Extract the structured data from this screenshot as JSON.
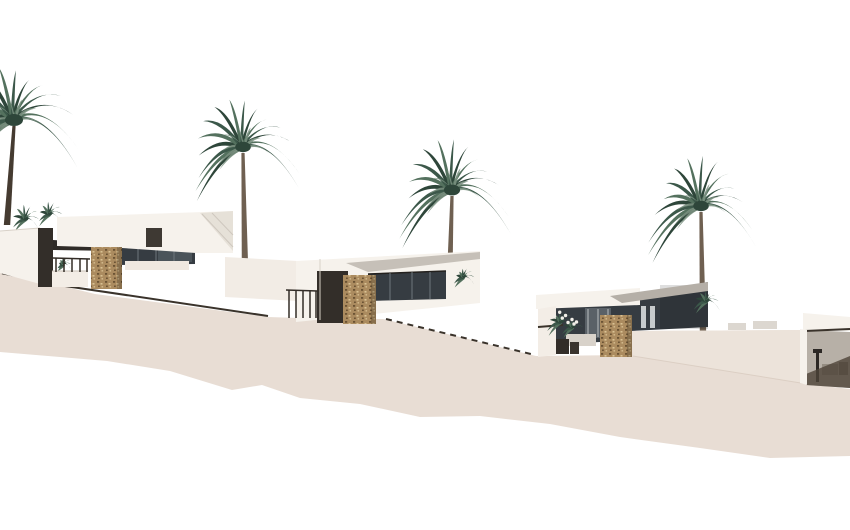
{
  "scene": {
    "type": "architectural-exterior-render",
    "subject": "Row of four modern white flat-roof hillside villas stepping down a beige slope with tall palm trees on a white background",
    "image_width": 850,
    "image_height": 530
  },
  "colors": {
    "background": "#ffffff",
    "terrain": "#e8ddd4",
    "terrain_light": "#ece3da",
    "wall_white": "#f6f2ec",
    "back_wall": "#f2ece5",
    "roof_gray": "#c6c0b8",
    "roof_gray_dark": "#b5afa7",
    "interior_gray": "#b7b0a7",
    "glass": "#363c42",
    "glass_light": "#6d767c",
    "pane_light": "#4b545a",
    "panel_dark": "#332e29",
    "soffit": "#2f2b27",
    "chimney": "#3e3933",
    "line_dark": "#3a332b",
    "stone": "#ab8b5f",
    "stone_dark": "#6b5334",
    "stone_light": "#d9c193",
    "palm_deep": "#2e463a",
    "palm_dark": "#3c584a",
    "palm_mid": "#54715e",
    "palm_light": "#7d9383",
    "trunk": "#6f6051",
    "trunk_dark": "#453b31",
    "shadow_brown": "#4e4338",
    "ledge": "#efe8e0",
    "side_wall": "#f3ede6",
    "sofa": "#d8d2ca",
    "furniture_light": "#948c81",
    "furniture_dark": "#2c2825",
    "distant_roof": "#dcd7d0",
    "crease": "#cfc8bf",
    "edge_light": "#d8d1c8",
    "white_accent": "#f2efe9"
  },
  "palms": [
    {
      "name": "palm-tree-1",
      "crown_x": 14,
      "crown_y": 120,
      "size": 60,
      "base_x": 7,
      "base_y": 225,
      "trunk": "trunk_dark"
    },
    {
      "name": "palm-tree-2",
      "crown_x": 243,
      "crown_y": 147,
      "size": 52,
      "base_x": 245,
      "base_y": 268,
      "trunk": "trunk"
    },
    {
      "name": "palm-tree-3",
      "crown_x": 452,
      "crown_y": 190,
      "size": 54,
      "base_x": 449,
      "base_y": 302,
      "trunk": "trunk"
    },
    {
      "name": "palm-tree-4",
      "crown_x": 701,
      "crown_y": 206,
      "size": 52,
      "base_x": 703,
      "base_y": 332,
      "trunk": "trunk"
    }
  ],
  "bushes": [
    {
      "name": "shrub-left-terrace-a",
      "x": 26,
      "y": 219,
      "size": 15,
      "layer": "back",
      "flowers": false
    },
    {
      "name": "shrub-left-terrace-b",
      "x": 50,
      "y": 214,
      "size": 13,
      "layer": "back",
      "flowers": false
    },
    {
      "name": "planter-plant-villa-1",
      "x": 64,
      "y": 264,
      "size": 7,
      "layer": "mid",
      "flowers": false
    },
    {
      "name": "shrub-villa-2-right",
      "x": 464,
      "y": 277,
      "size": 10,
      "layer": "front",
      "flowers": false
    },
    {
      "name": "terrace-plant-villa-3-a",
      "x": 561,
      "y": 322,
      "size": 13,
      "layer": "front",
      "flowers": true
    },
    {
      "name": "terrace-plant-villa-3-b",
      "x": 573,
      "y": 327,
      "size": 10,
      "layer": "front",
      "flowers": true
    },
    {
      "name": "shrub-villa-4-left",
      "x": 707,
      "y": 301,
      "size": 12,
      "layer": "front",
      "flowers": false
    }
  ],
  "villas": [
    {
      "name": "villa-1",
      "position": "upper-left",
      "features": [
        "flat white roof",
        "dark glass facade",
        "stone-clad pillar",
        "terrace railing",
        "white planter"
      ]
    },
    {
      "name": "villa-2",
      "position": "mid-left",
      "features": [
        "flat white roof",
        "dark glass facade",
        "stone-clad pillar",
        "terrace railing"
      ]
    },
    {
      "name": "villa-3",
      "position": "mid-right",
      "features": [
        "flat white roof",
        "dark glass facade",
        "stone-clad pillar",
        "terrace plants",
        "outdoor sofa"
      ]
    },
    {
      "name": "villa-4",
      "position": "lower-right",
      "features": [
        "flat white roof",
        "covered terrace interior",
        "terrace furniture",
        "cast shadow"
      ]
    }
  ],
  "terrain": {
    "description": "stepped beige hillside with retaining walls descending left to right",
    "stair_rail": true,
    "dashed_steps": true
  }
}
